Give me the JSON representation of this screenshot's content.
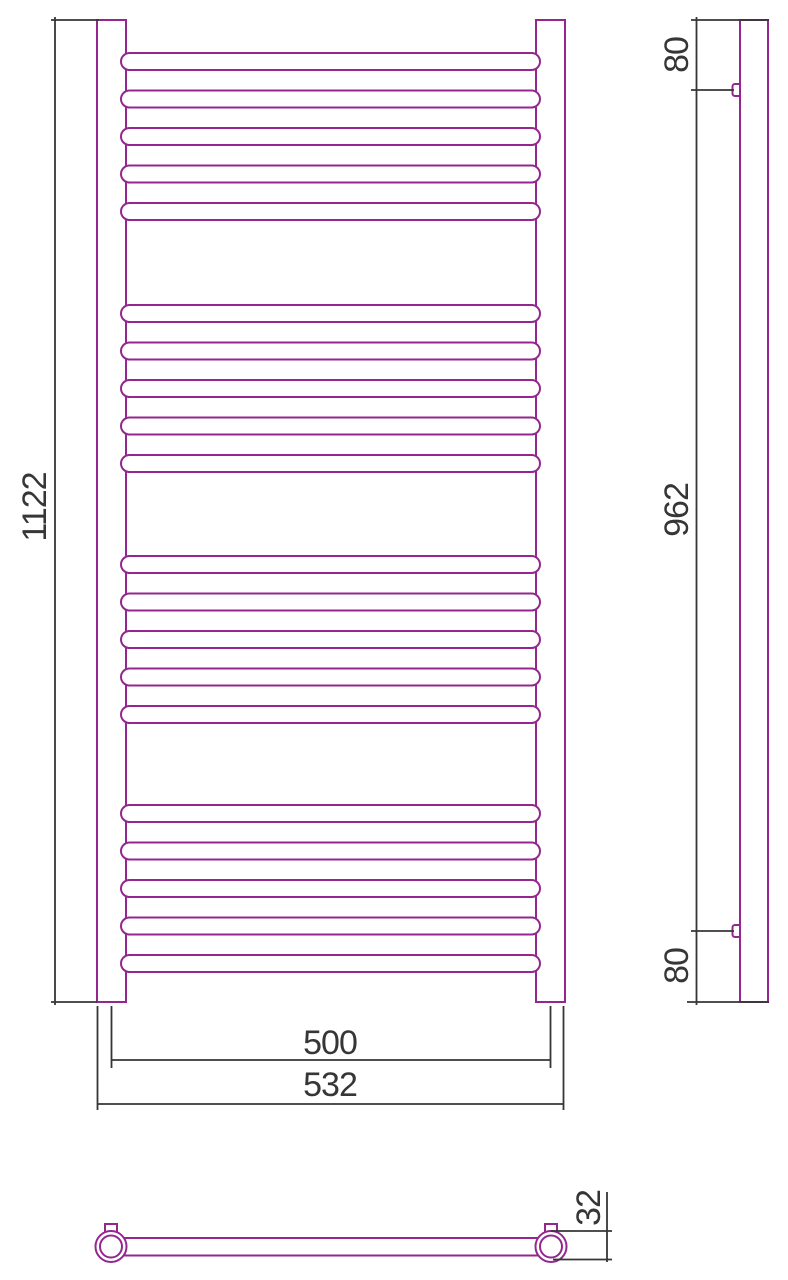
{
  "colors": {
    "outline": "#93278f",
    "dimension": "#363636",
    "background": "#ffffff"
  },
  "front_view": {
    "dim_height": "1122",
    "dim_center_width": "500",
    "dim_overall_width": "532"
  },
  "side_view": {
    "dim_top_offset": "80",
    "dim_bracket_span": "962",
    "dim_bottom_offset": "80"
  },
  "bottom_view": {
    "dim_tube_diameter": "32"
  }
}
